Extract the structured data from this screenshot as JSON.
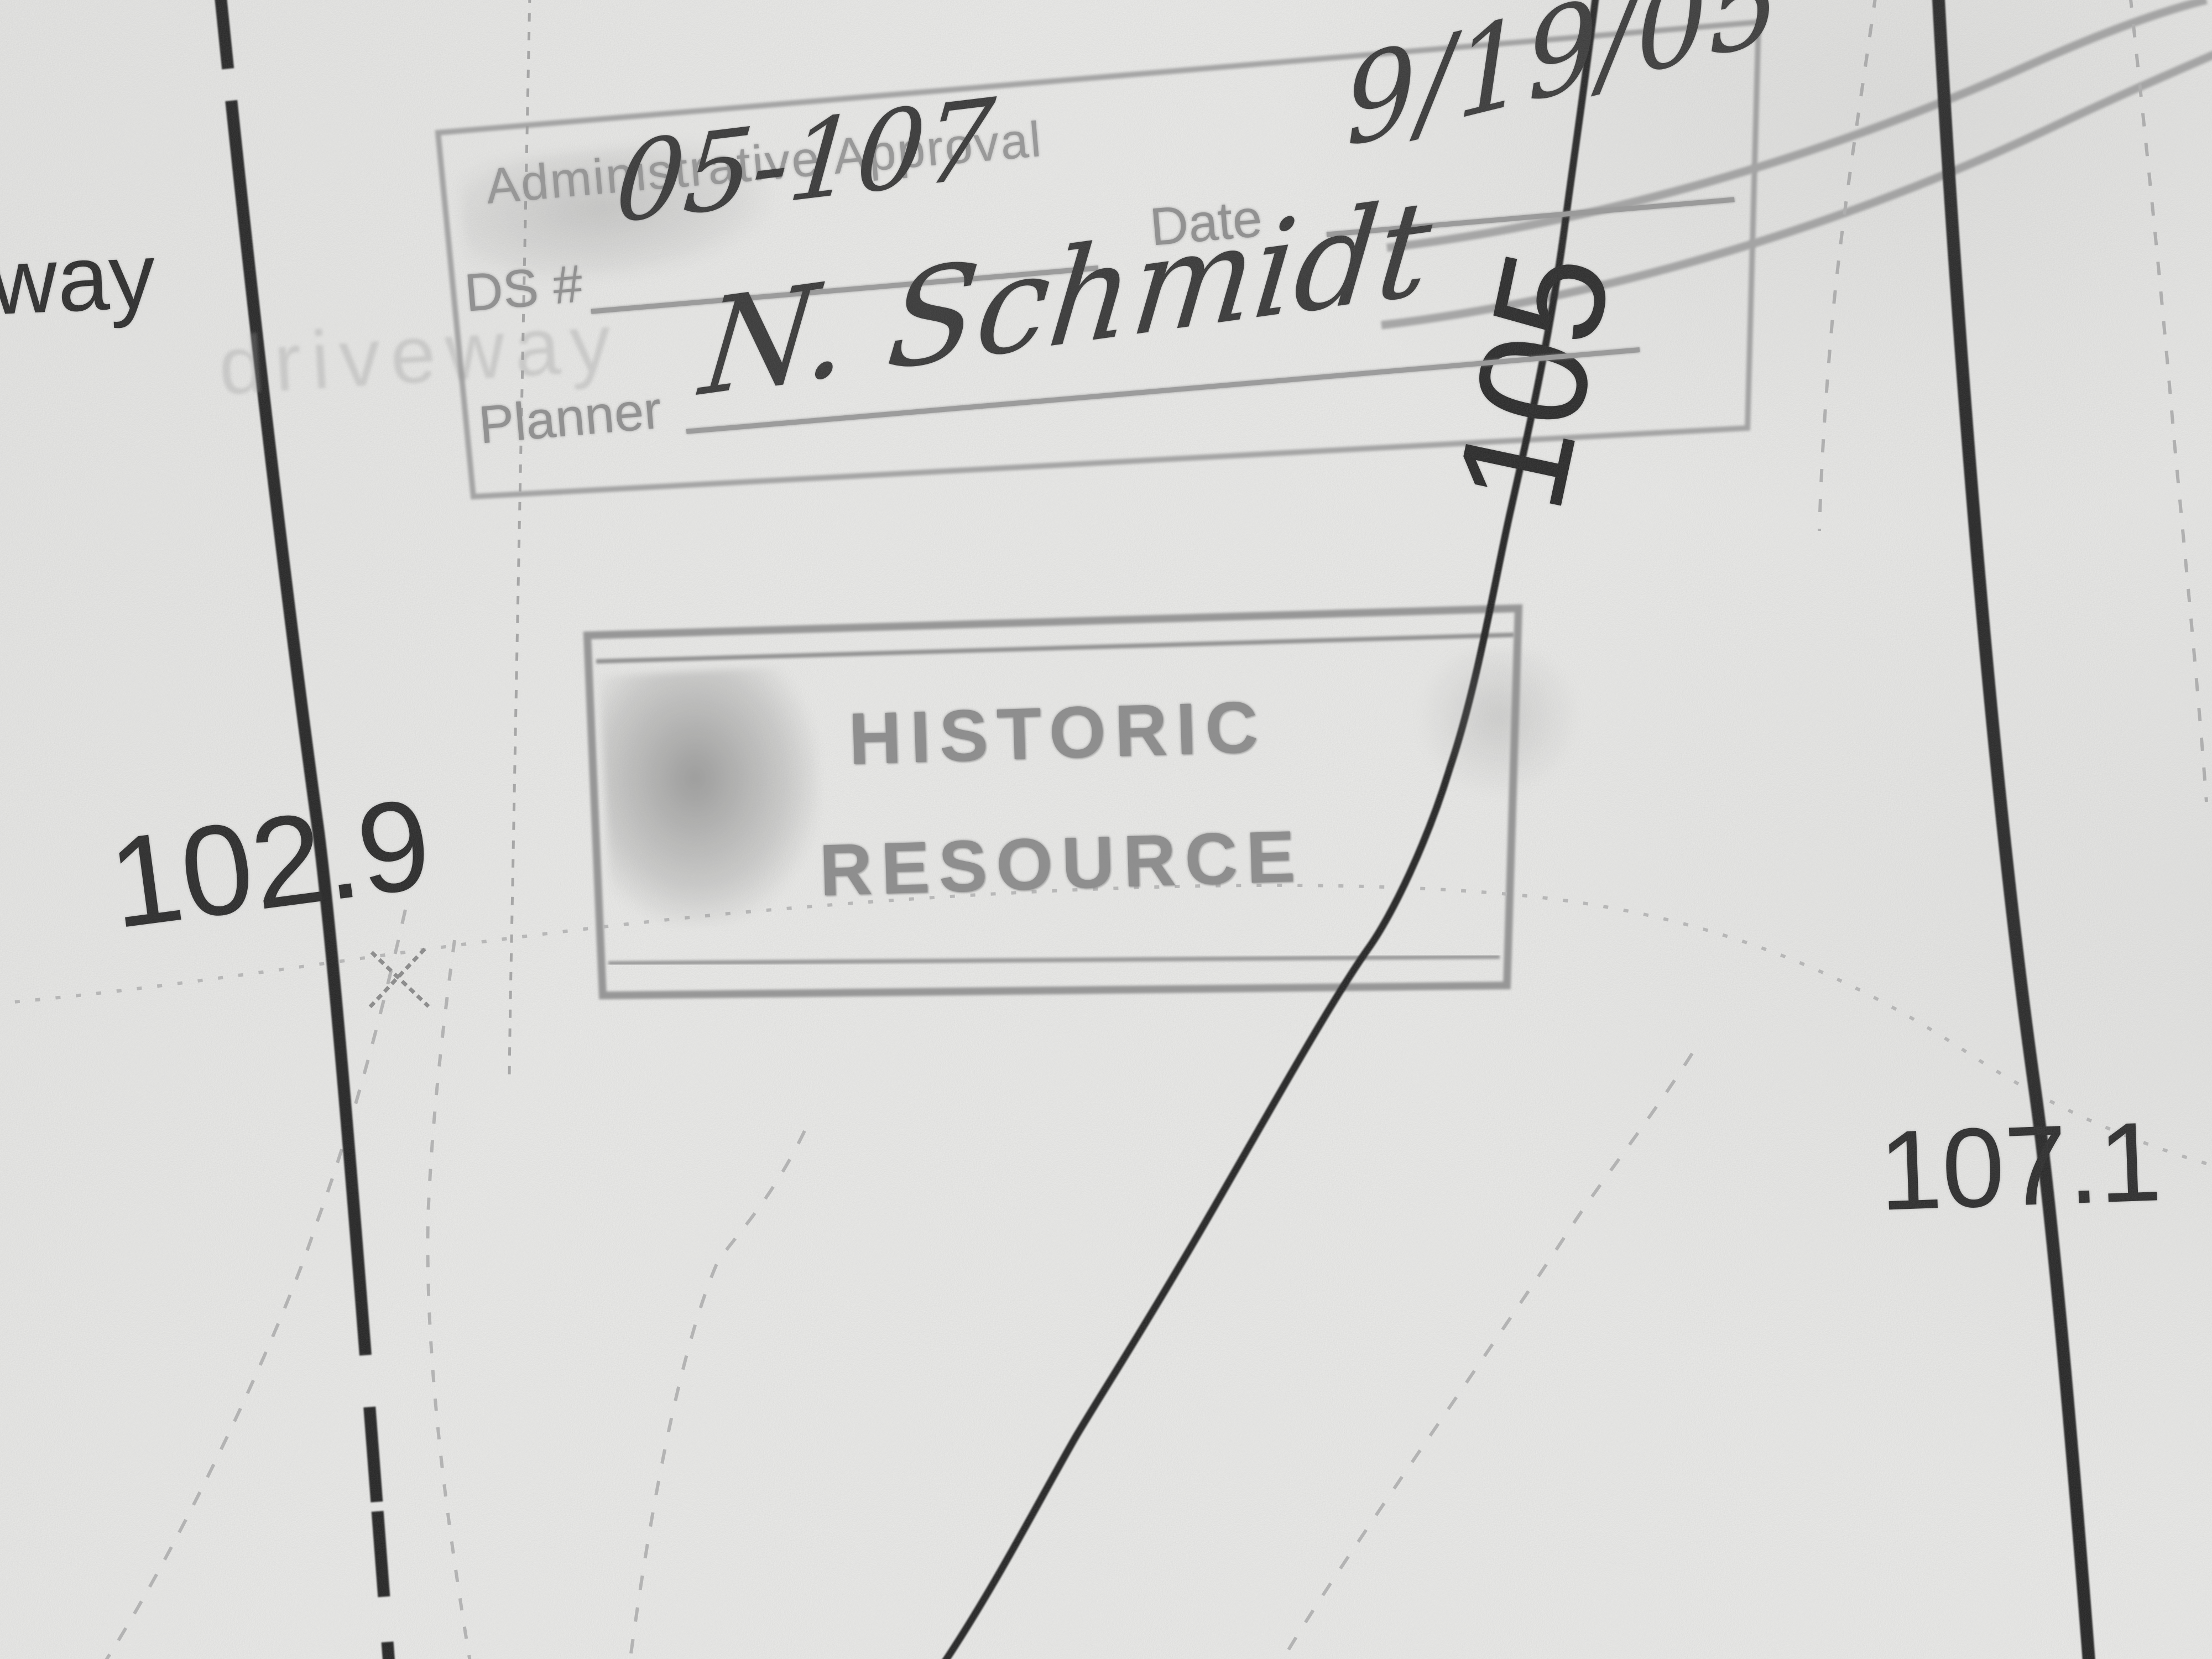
{
  "map_labels": {
    "street_name_partial": "way",
    "driveway_ghost": "driveway",
    "spot_elevation_left": "102.9",
    "contour_label": "105",
    "spot_elevation_right": "107.1"
  },
  "approval_stamp": {
    "title": "Administrative Approval",
    "case_number_label": "DS #",
    "case_number_value": "05-107",
    "date_label": "Date",
    "date_value": "9/19/05",
    "planner_label": "Planner",
    "planner_value": "N. Schmidt"
  },
  "historic_stamp": {
    "line1": "HISTORIC",
    "line2": "RESOURCE"
  },
  "colors": {
    "paper": "#f2f2f0",
    "ink": "#1a1a1a",
    "pencil": "#949494",
    "faint_dotted": "#bdbdbd"
  }
}
